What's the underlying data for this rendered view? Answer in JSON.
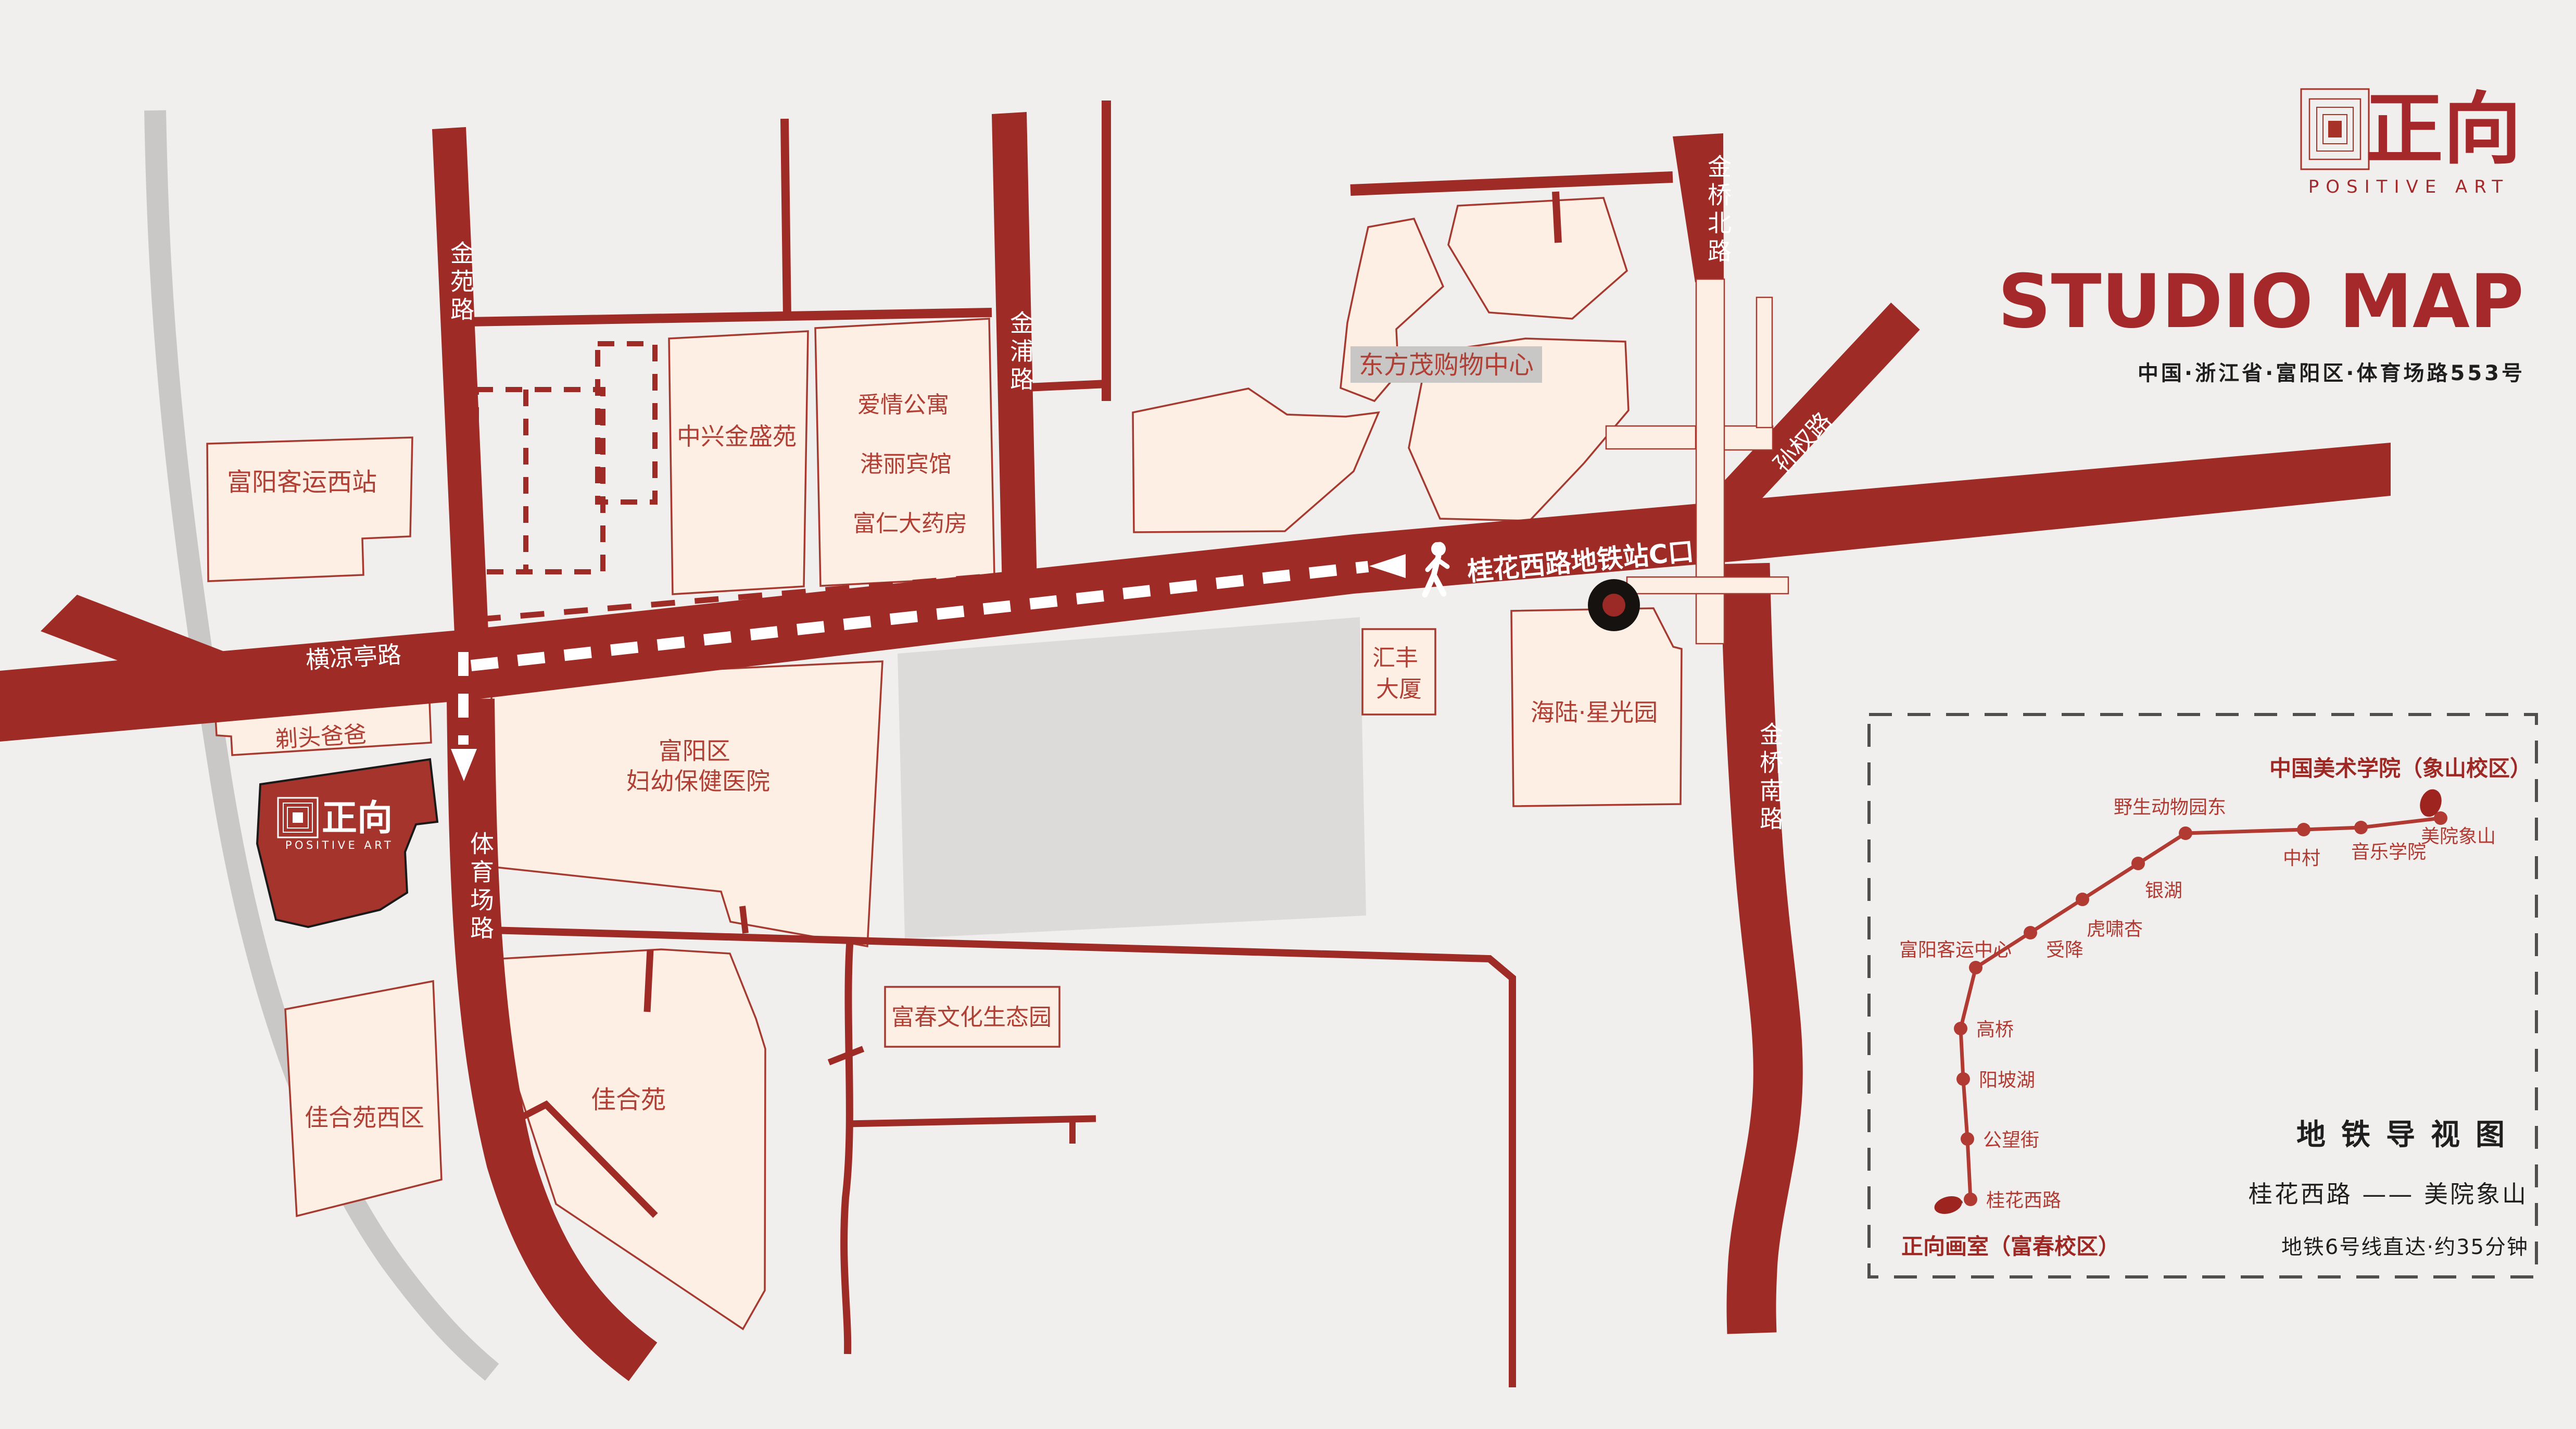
{
  "header": {
    "brand_cn": "正向",
    "brand_en": "POSITIVE ART",
    "title": "STUDIO MAP",
    "subtitle": "中国·浙江省·富阳区·体育场路553号"
  },
  "studio_marker": {
    "brand_cn": "正向",
    "brand_en": "POSITIVE ART"
  },
  "map": {
    "roads": {
      "jinyuan": "金苑路",
      "jinpu": "金浦路",
      "jinqiao_north": "金桥北路",
      "sunquan": "孙权路",
      "jinqiao_south": "金桥南路",
      "tiyuchang": "体育场路",
      "hengliangting": "横凉亭路"
    },
    "route": {
      "exit_label": "桂花西路地铁站C口"
    },
    "buildings": {
      "fuyang_west_bus": "富阳客运西站",
      "zhongxing": "中兴金盛苑",
      "aiqing": "爱情公寓",
      "gangli": "港丽宾馆",
      "furen": "富仁大药房",
      "dongfangmao": "东方茂购物中心",
      "huifeng_1": "汇丰",
      "huifeng_2": "大厦",
      "hailu": "海陆·星光园",
      "hospital_1": "富阳区",
      "hospital_2": "妇幼保健医院",
      "titou": "剃头爸爸",
      "jiaheyuan_west": "佳合苑西区",
      "jiaheyuan": "佳合苑",
      "fuchun_park": "富春文化生态园"
    }
  },
  "metro": {
    "panel_title": "中国美术学院（象山校区）",
    "origin": "正向画室（富春校区）",
    "heading": "地铁导视图",
    "route_summary": "桂花西路 —— 美院象山",
    "footnote": "地铁6号线直达·约35分钟",
    "stations": {
      "guihua": "桂花西路",
      "gongwang": "公望街",
      "yangpo": "阳坡湖",
      "gaoqiao": "高桥",
      "keyun": "富阳客运中心",
      "shoujiang": "受降",
      "huxiao": "虎啸杏",
      "yinhu": "银湖",
      "yesheng": "野生动物园东",
      "zhongcun": "中村",
      "yinyue": "音乐学院",
      "meiyuan": "美院象山"
    }
  },
  "colors": {
    "road": "#9e2b26",
    "building_fill": "#fdefe3",
    "building_stroke": "#a63a30",
    "label_red": "#b04036",
    "accent_red": "#a5292a",
    "gray_block": "#dcdbda",
    "river_gray": "#c9c8c7",
    "panel_border": "#4f4f4f",
    "ink": "#1f1f1f",
    "metro_line": "#b13a32"
  }
}
